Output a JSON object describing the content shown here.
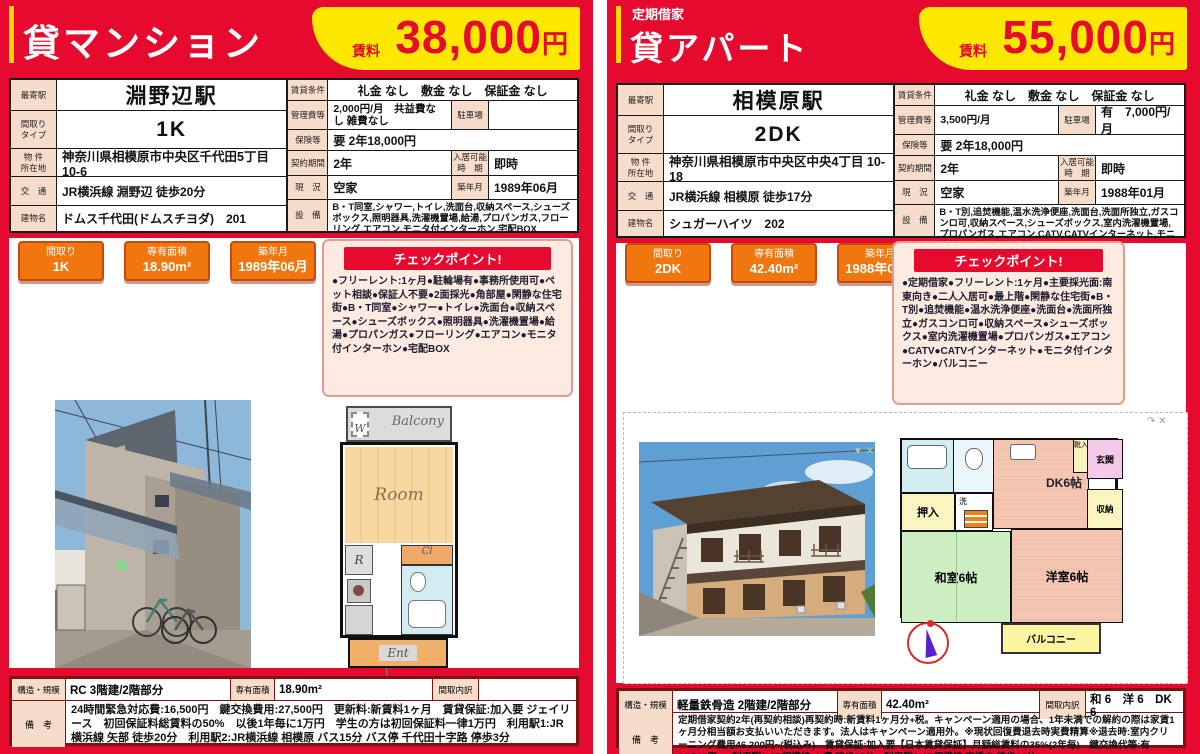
{
  "colors": {
    "brand_red": "#e50a2e",
    "accent_yellow": "#ffe800",
    "badge_orange": "#f0760e",
    "label_peach": "#f6dcca",
    "table_maroon": "#7d1212"
  },
  "left_flyer": {
    "category": "貸マンション",
    "rent_label": "賃料",
    "rent": "38,000",
    "rent_unit": "円",
    "info": {
      "station_label": "最寄駅",
      "station": "淵野辺駅",
      "layout_label": "間取り\nタイプ",
      "layout": "1K",
      "address_label": "物 件\n所在地",
      "address": "神奈川県相模原市中央区千代田5丁目10-6",
      "access_label": "交　通",
      "access": "JR横浜線 淵野辺 徒歩20分",
      "building_label": "建物名",
      "building": "ドムス千代田(ドムスチヨダ)　201",
      "terms_label": "賃貸条件",
      "terms": "礼金 なし　敷金 なし　保証金 なし",
      "mgmt_label": "管理費等",
      "mgmt": "2,000円/月　共益費なし 雑費なし",
      "parking_label": "駐車場",
      "parking": "",
      "insurance_label": "保険等",
      "insurance": "要 2年18,000円",
      "contract_label": "契約期間",
      "contract": "2年",
      "movein_label": "入居可能\n時　期",
      "movein": "即時",
      "status_label": "現　況",
      "status": "空家",
      "built_label": "築年月",
      "built": "1989年06月",
      "equip_label": "設　備",
      "equip": "B・T同室,シャワー,トイレ,洗面台,収納スペース,シューズボックス,照明器具,洗濯機置場,給湯,プロパンガス,フローリング,エアコン,モニタ付インターホン,宅配BOX"
    },
    "badges": [
      {
        "label": "間取り",
        "value": "1K"
      },
      {
        "label": "専有面積",
        "value": "18.90m²"
      },
      {
        "label": "築年月",
        "value": "1989年06月"
      }
    ],
    "checkpoint": {
      "title": "チェックポイント!",
      "body": "●フリーレント:1ヶ月●駐輪場有●事務所使用可●ペット相談●保証人不要●2面採光●角部屋●閑静な住宅街●B・T同室●シャワー●トイレ●洗面台●収納スペース●シューズボックス●照明器具●洗濯機置場●給湯●プロパンガス●フローリング●エアコン●モニタ付インターホン●宅配BOX"
    },
    "floorplan": {
      "balcony": "Balcony",
      "w": "W",
      "room": "Room",
      "r": "R",
      "cl": "Cl",
      "ent": "Ent"
    },
    "summary": {
      "structure_label": "構造・規模",
      "structure": "RC 3階建/2階部分",
      "area_label": "専有面積",
      "area": "18.90m²",
      "rooms_label": "間取内訳",
      "rooms": "",
      "notes_label": "備　考",
      "notes": "24時間緊急対応費:16,500円　鍵交換費用:27,500円　更新料:新賃料1ヶ月　賃貸保証:加入要 ジェイリース　初回保証料総賃料の50%　以後1年毎に1万円　学生の方は初回保証料一律1万円　利用駅1:JR横浜線 矢部 徒歩20分　利用駅2:JR横浜線 相模原 バス15分 バス停 千代田十字路 停歩3分"
    }
  },
  "right_flyer": {
    "lease_type": "定期借家",
    "category": "貸アパート",
    "rent_label": "賃料",
    "rent": "55,000",
    "rent_unit": "円",
    "info": {
      "station_label": "最寄駅",
      "station": "相模原駅",
      "layout_label": "間取り\nタイプ",
      "layout": "2DK",
      "address_label": "物 件\n所在地",
      "address": "神奈川県相模原市中央区中央4丁目 10-18",
      "access_label": "交　通",
      "access": "JR横浜線 相模原 徒歩17分",
      "building_label": "建物名",
      "building": "シュガーハイツ　202",
      "terms_label": "賃貸条件",
      "terms": "礼金 なし　敷金 なし　保証金 なし",
      "mgmt_label": "管理費等",
      "mgmt": "3,500円/月",
      "parking_label": "駐車場",
      "parking": "有　7,000円/月",
      "insurance_label": "保険等",
      "insurance": "要 2年18,000円",
      "contract_label": "契約期間",
      "contract": "2年",
      "movein_label": "入居可能\n時　期",
      "movein": "即時",
      "status_label": "現　況",
      "status": "空家",
      "built_label": "築年月",
      "built": "1988年01月",
      "equip_label": "設　備",
      "equip": "B・T別,追焚機能,温水洗浄便座,洗面台,洗面所独立,ガスコンロ可,収納スペース,シューズボックス,室内洗濯機置場,プロパンガス,エアコン,CATV,CATVインターネット,モニタ付インターホン,バルコニー"
    },
    "badges": [
      {
        "label": "間取り",
        "value": "2DK"
      },
      {
        "label": "専有面積",
        "value": "42.40m²"
      },
      {
        "label": "築年月",
        "value": "1988年01月"
      }
    ],
    "checkpoint": {
      "title": "チェックポイント!",
      "body": "●定期借家●フリーレント:1ヶ月●主要採光面:南東向き●二人入居可●最上階●閑静な住宅街●B・T別●追焚機能●温水洗浄便座●洗面台●洗面所独立●ガスコンロ可●収納スペース●シューズボックス●室内洗濯機置場●プロパンガス●エアコン●CATV●CATVインターネット●モニタ付インターホン●バルコニー"
    },
    "floorplan": {
      "genkan": "玄関",
      "kutsu": "靴入",
      "dk": "DK6帖",
      "oshiire": "押入",
      "sen": "洗",
      "washitsu": "和室6帖",
      "yoshitsu": "洋室6帖",
      "shuno": "収納",
      "balcony": "バルコニー"
    },
    "summary": {
      "structure_label": "構造・規模",
      "structure": "軽量鉄骨造 2階建/2階部分",
      "area_label": "専有面積",
      "area": "42.40m²",
      "rooms_label": "間取内訳",
      "rooms": "和 6　洋 6　DK 6",
      "notes_label": "備　考",
      "notes": "定期借家契約2年(再契約相談)再契約時:新賃料1ヶ月分+税。キャンペーン適用の場合、1年未満での解約の際は家賃1ヶ月分相当額お支払いいただきます。法人はキャンペーン適用外。※現状回復費退去時実費精算※退去時:室内クリーニング費用46,200円~(税込み)　賃貸保証:加入要【日本賃貸保証】月額総賃料の35%(2年毎)　鍵交換代等:有 16,500円~　利用駅1:JR相模線 上溝 徒歩25分　利用駅2:JR相模線 南橋本 徒歩26分"
    }
  }
}
